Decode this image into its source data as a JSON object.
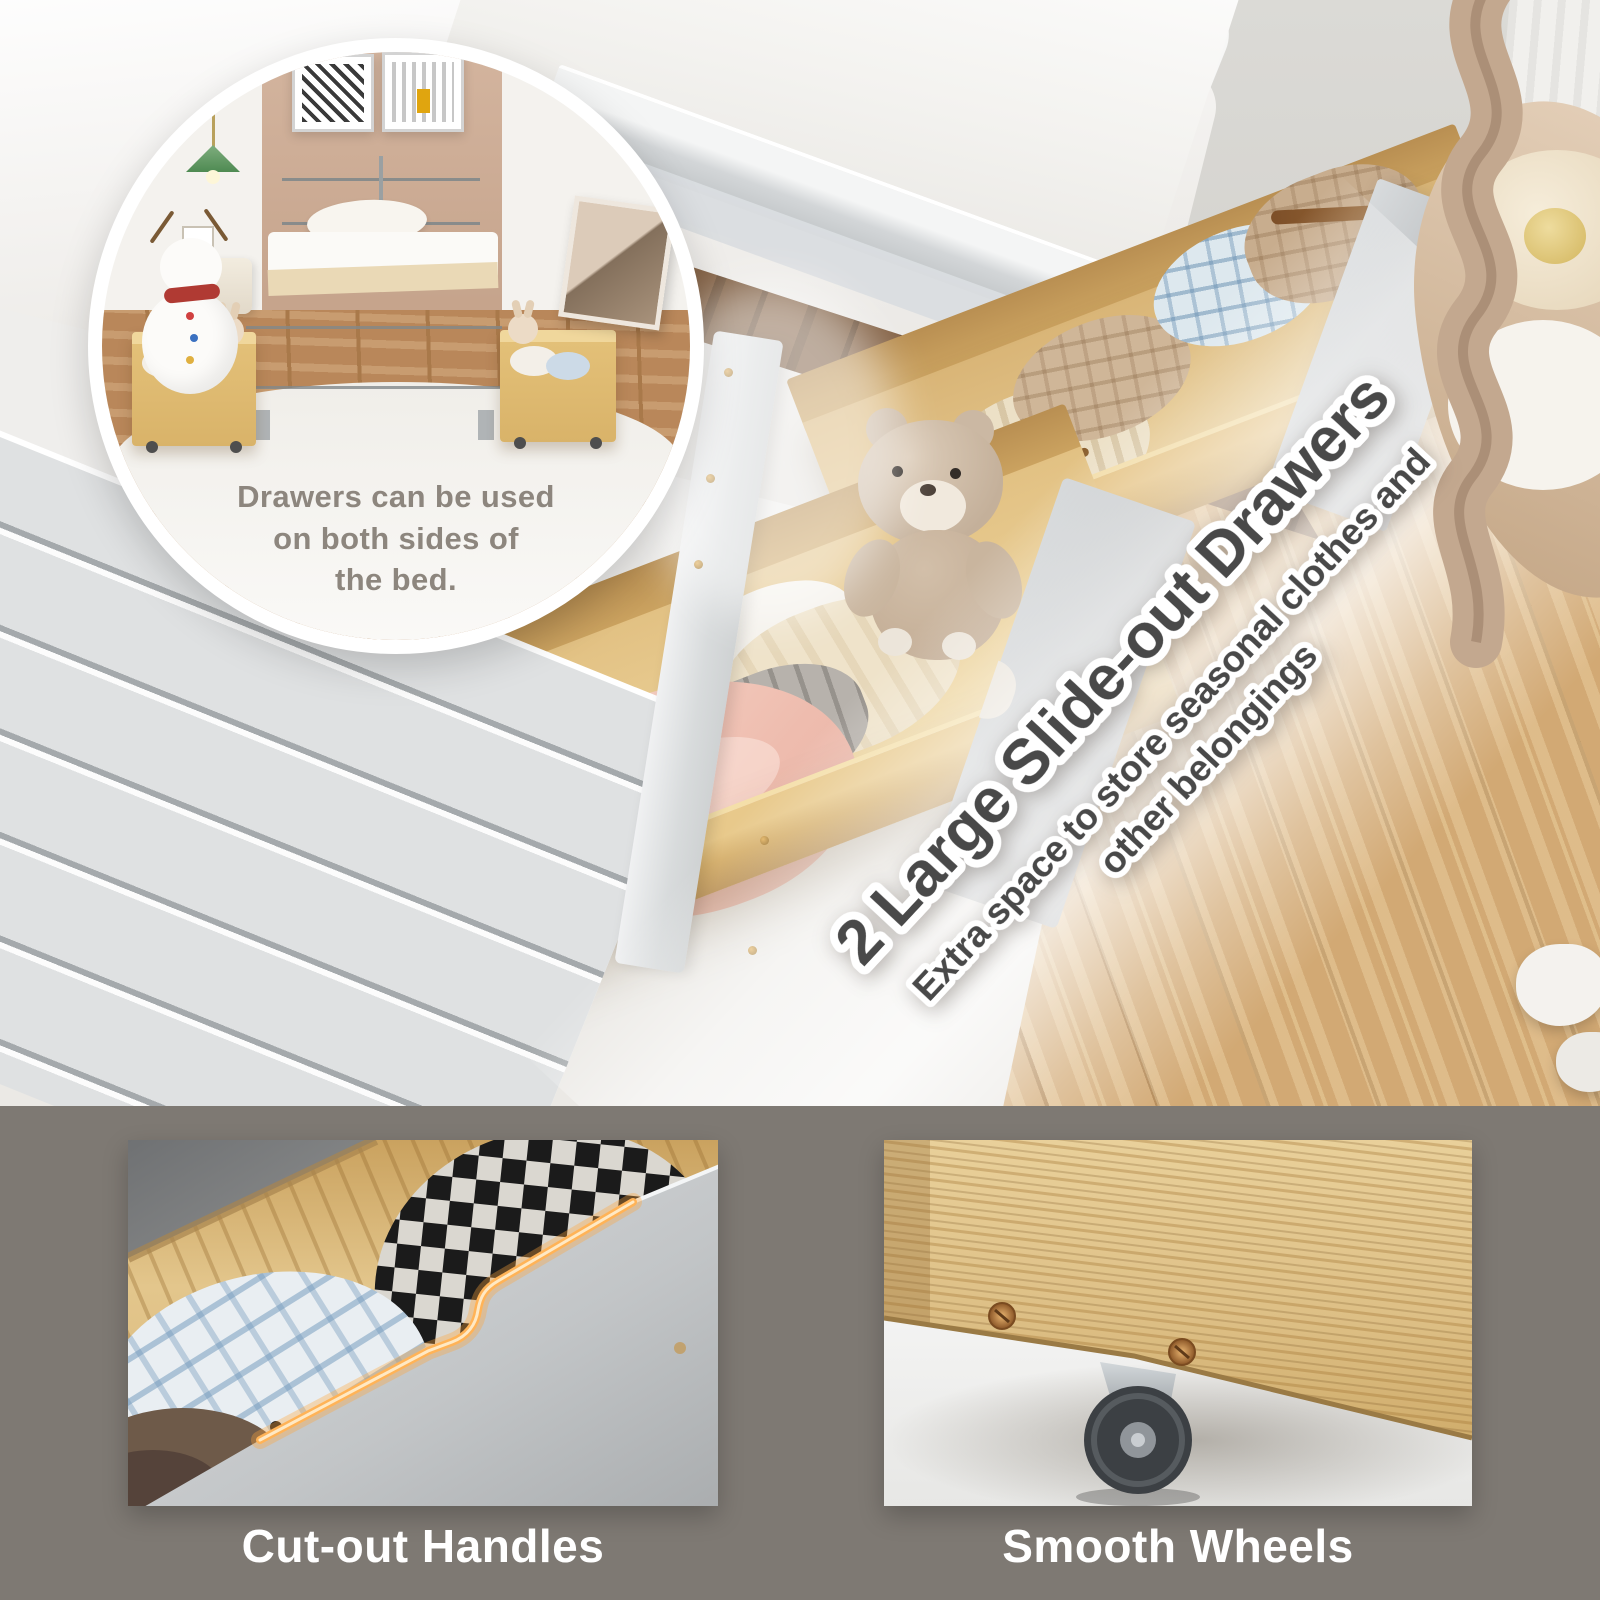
{
  "inset": {
    "caption_lines": [
      "Drawers can be used",
      "on both sides of",
      "the bed."
    ]
  },
  "overlay": {
    "headline": "2 Large Slide-out Drawers",
    "subtitle_line1": "Extra space to store seasonal clothes and",
    "subtitle_line2": "other belongings"
  },
  "features": [
    {
      "label": "Cut-out Handles"
    },
    {
      "label": "Smooth Wheels"
    }
  ],
  "colors": {
    "band_bg": "#7e7973",
    "headline_fill": "#494949",
    "headline_stroke": "#ffffff",
    "caption_text": "#8d867e",
    "label_text": "#ffffff",
    "glow": "#ffb357",
    "wood": "#e3c68c",
    "wood_floor": "#d2a974",
    "panel_gray": "#c2c5c7",
    "copper": "#c08143"
  }
}
